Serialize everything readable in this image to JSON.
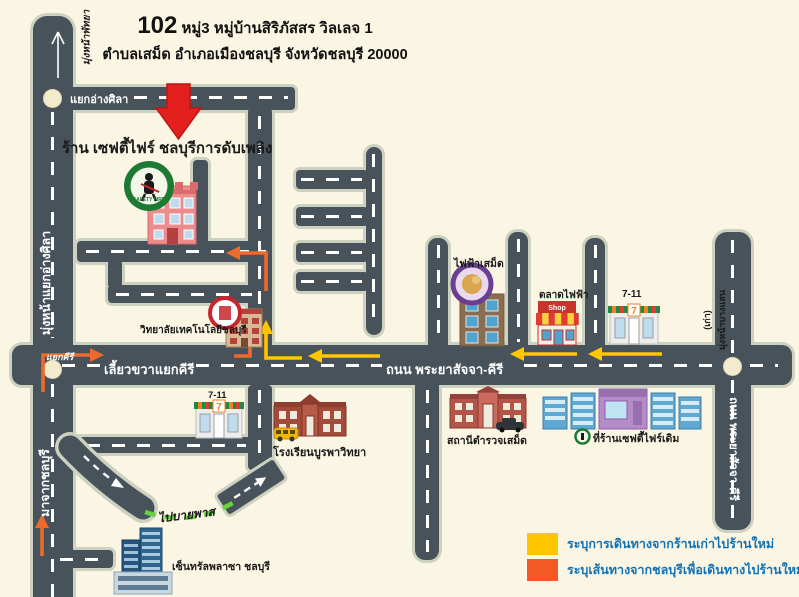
{
  "header": {
    "address_number": "102",
    "address_line1": "หมู่3 หมู่บ้านสิริภัสสร วิลเลจ 1",
    "address_line2": "ตำบลเสม็ด อำเภอเมืองชลบุรี จังหวัดชลบุรี 20000"
  },
  "shop": {
    "name": "ร้าน เซฟตี้ไฟร์ ชลบุรีการดับเพลิง",
    "logo_text": "SAFETY FIRE"
  },
  "roads": {
    "main_road": "ถนน พระยาสัจจา-คีรี",
    "right_road": "ถนน พระยาสัจจา-คีรี",
    "left_road_up": "มุ่งหน้าแยกอ่างศิลา",
    "left_road_top_dest": "มุ่งหน้าพัทยา",
    "left_road_down": "มาจากชลบุรี",
    "angsila_junction": "แยกอ่างศิลา",
    "khiri_junction": "แยกคีรี",
    "khiri_turn": "เลี้ยวขวาแยกคีรี",
    "north_dest": "มุ่งหน้าบางแสน",
    "north_dest_note": "(เก่า)",
    "bypass": "ไปบายพาส"
  },
  "places": {
    "college": {
      "label": "วิทยาลัยเทคโนโลยีชลบุรี"
    },
    "samet_electricity": {
      "label": "ไฟฟ้าเสม็ด"
    },
    "electric_market": {
      "label": "ตลาดไฟฟ้า",
      "sign": "Shop"
    },
    "seven_eleven_north": {
      "label": "7-11",
      "logo": "7"
    },
    "seven_eleven_south": {
      "label": "7-11",
      "logo": "7"
    },
    "school": {
      "label": "โรงเรียนบูรพาวิทยา"
    },
    "police_station": {
      "label": "สถานีตำรวจเสม็ด"
    },
    "old_shop": {
      "label": "ที่ร้านเซฟตี้ไฟร์เดิม"
    },
    "central_plaza": {
      "label": "เซ็นทรัลพลาซา ชลบุรี"
    }
  },
  "legend": {
    "items": [
      {
        "color": "#FFC600",
        "label": "ระบุการเดินทางจากร้านเก่าไปร้านใหม่"
      },
      {
        "color": "#F15A24",
        "label": "ระบุเส้นทางจากชลบุรีเพื่อเดินทางไปร้านใหม่"
      }
    ]
  },
  "colors": {
    "background": "#FBF5E3",
    "road": "#47525A",
    "road_casing": "#CDD1BF",
    "route_from_old_shop": "#FFC600",
    "route_from_chonburi": "#ED6A2D",
    "marker_red": "#E3201D",
    "bypass_green": "#66D23C",
    "legend_text": "#1273B4"
  }
}
